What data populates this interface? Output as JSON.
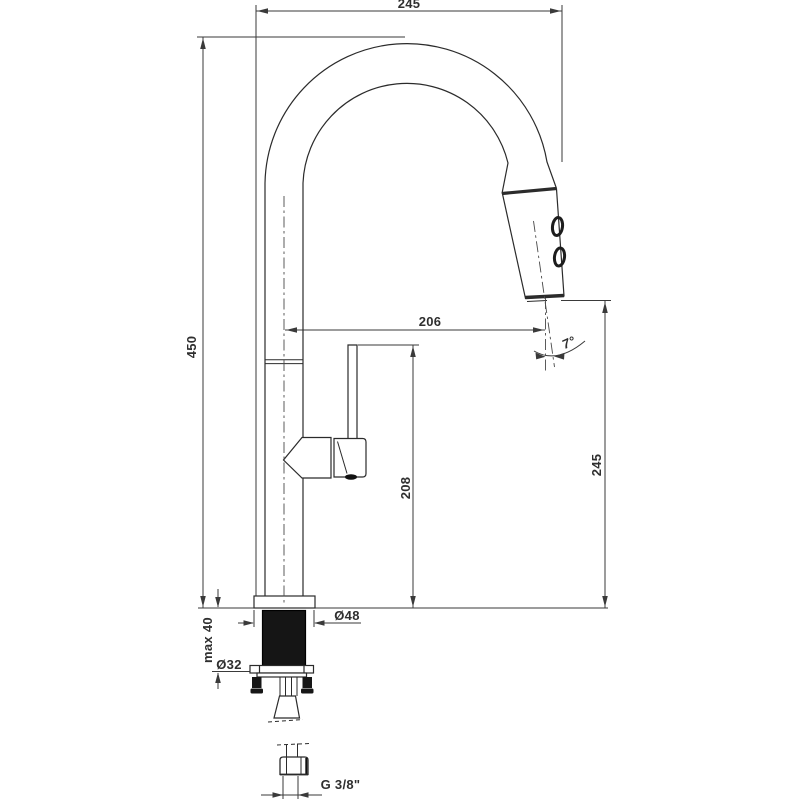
{
  "drawing": {
    "type": "technical-dimension-drawing",
    "subject": "kitchen faucet with pull-out spray head, side elevation",
    "background_color": "#ffffff",
    "line_color": "#2b2b2b",
    "dimensions": {
      "top_width": "245",
      "total_height": "450",
      "spout_reach": "206",
      "handle_top_height": "208",
      "outlet_height": "245",
      "spray_angle": "7°",
      "escutcheon_diameter": "Ø48",
      "shank_diameter": "Ø32",
      "max_deck_thickness": "max 40",
      "connection_thread": "G 3/8\""
    }
  }
}
